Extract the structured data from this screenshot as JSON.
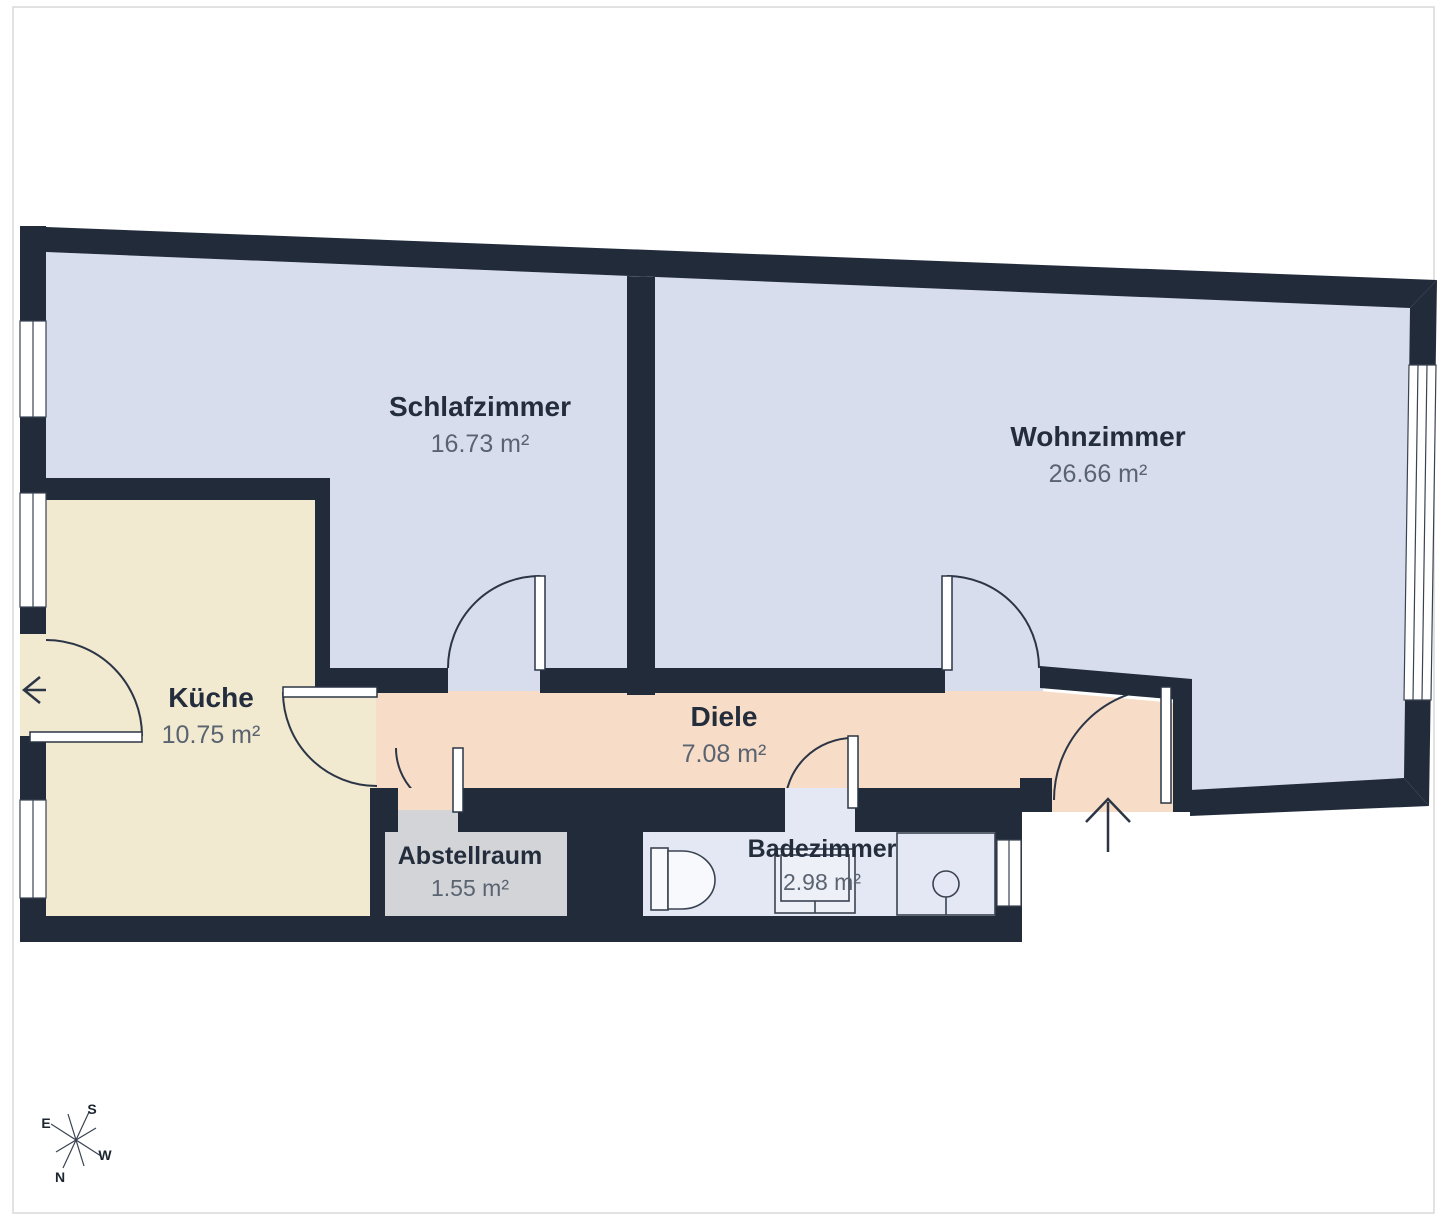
{
  "floorplan": {
    "rooms": {
      "schlafzimmer": {
        "name": "Schlafzimmer",
        "area": "16.73 m²"
      },
      "wohnzimmer": {
        "name": "Wohnzimmer",
        "area": "26.66 m²"
      },
      "kueche": {
        "name": "Küche",
        "area": "10.75 m²"
      },
      "diele": {
        "name": "Diele",
        "area": "7.08 m²"
      },
      "abstellraum": {
        "name": "Abstellraum",
        "area": "1.55 m²"
      },
      "badezimmer": {
        "name": "Badezimmer",
        "area": "2.98 m²"
      }
    },
    "compass": {
      "south": "S",
      "east": "E",
      "west": "W",
      "north": "N"
    },
    "colors": {
      "wall": "#212b3a",
      "line": "#2b3545",
      "bedroom_floor": "#d8ddee",
      "living_floor": "#d8ddee",
      "kitchen_floor": "#f1e9d0",
      "hall_floor": "#f7dcc7",
      "storage_floor": "#d2d4d8",
      "bath_floor": "#e4e8f4",
      "window_fill": "#ffffff"
    }
  }
}
